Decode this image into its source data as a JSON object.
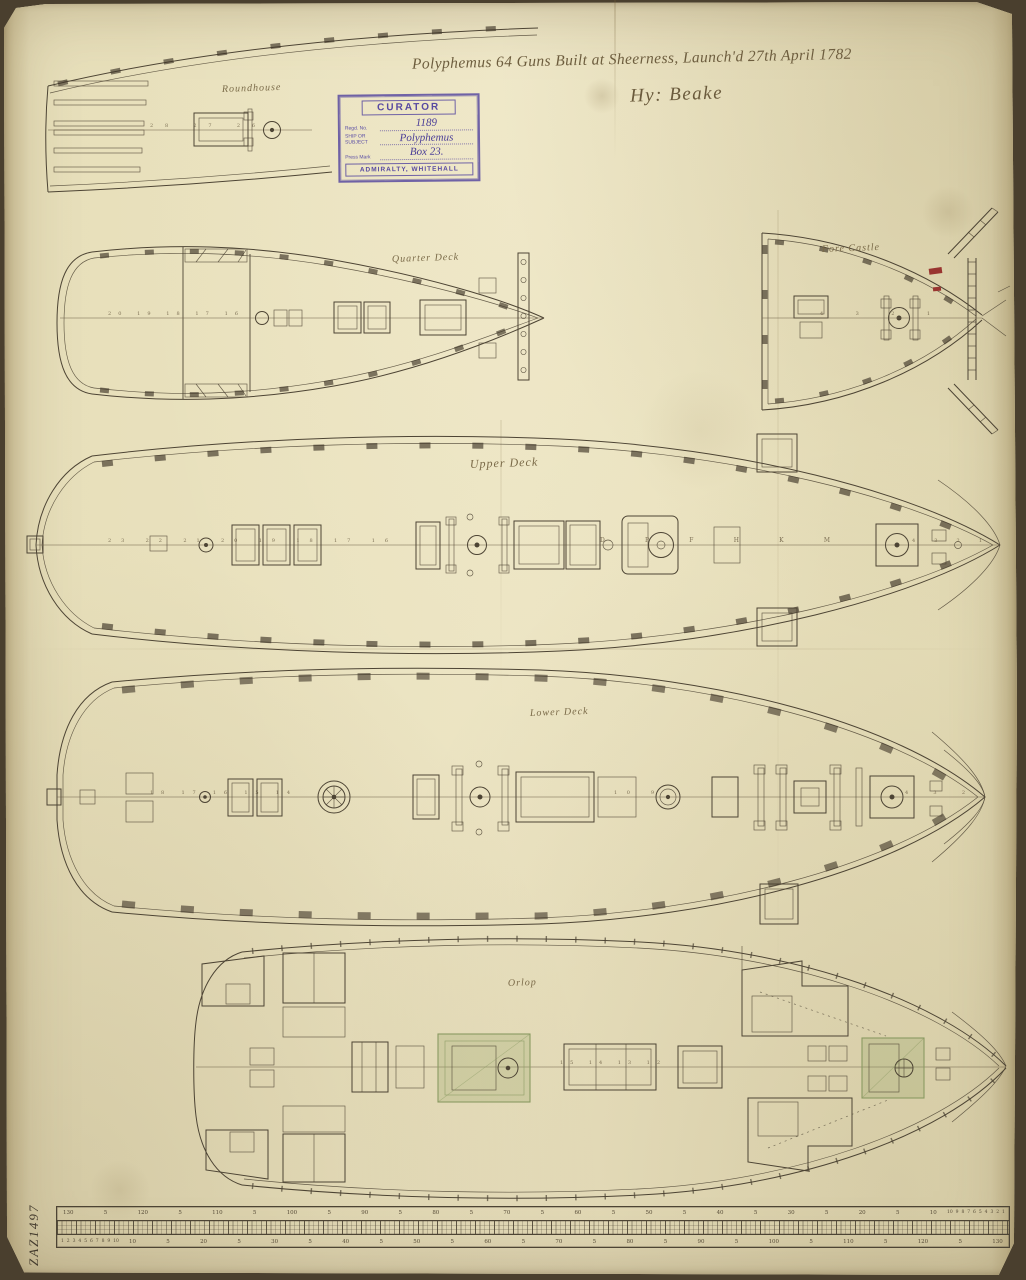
{
  "document": {
    "title_inscription": "Polyphemus 64 Guns Built at Sheerness, Launch'd 27th April 1782",
    "signature": "Hy: Beake",
    "reference_number": "ZAZ1497"
  },
  "stamp": {
    "header": "CURATOR",
    "fields": [
      {
        "label": "Regd. No.",
        "value": "1189"
      },
      {
        "label": "SHIP OR SUBJECT",
        "value": "Polyphemus"
      },
      {
        "label": "Press Mark",
        "value": "Box 23."
      }
    ],
    "footer": "ADMIRALTY, WHITEHALL"
  },
  "plans": {
    "roundhouse": {
      "label": "Roundhouse",
      "stations": "28 27 26"
    },
    "quarter_deck": {
      "label": "Quarter Deck",
      "stations": "20 19 18 17 16"
    },
    "fore_castle": {
      "label": "Fore Castle",
      "stations": "4 3 2 1"
    },
    "upper_deck": {
      "label": "Upper Deck",
      "stations_aft": "23 22 21 20 19 18 17 16",
      "letters": "D P F H K M",
      "stations_fore": "4 3 2 1"
    },
    "lower_deck": {
      "label": "Lower Deck",
      "stations_aft": "18 17 16 15 14",
      "stations_mid": "10 9",
      "stations_fore": "4 3 2"
    },
    "orlop": {
      "label": "Orlop",
      "stations": "15 14 13 12"
    }
  },
  "scale_bar": {
    "top_numbers": [
      "130",
      "5",
      "120",
      "5",
      "110",
      "5",
      "100",
      "5",
      "90",
      "5",
      "80",
      "5",
      "70",
      "5",
      "60",
      "5",
      "50",
      "5",
      "40",
      "5",
      "30",
      "5",
      "20",
      "5",
      "10"
    ],
    "bottom_numbers": [
      "10",
      "5",
      "20",
      "5",
      "30",
      "5",
      "40",
      "5",
      "50",
      "5",
      "60",
      "5",
      "70",
      "5",
      "80",
      "5",
      "90",
      "5",
      "100",
      "5",
      "110",
      "5",
      "120",
      "5",
      "130"
    ],
    "left_subdivision_digits": [
      "1",
      "2",
      "3",
      "4",
      "5",
      "6",
      "7",
      "8",
      "9",
      "10"
    ],
    "right_subdivision_digits": [
      "10",
      "9",
      "8",
      "7",
      "6",
      "5",
      "4",
      "3",
      "2",
      "1"
    ]
  },
  "colors": {
    "paper": "#e9e1bd",
    "ink": "#4d4434",
    "handwriting_ink": "#6d5d3e",
    "stamp_purple": "#584aa2",
    "red_annotation": "#993530",
    "green_wash": "#8a9a62"
  }
}
